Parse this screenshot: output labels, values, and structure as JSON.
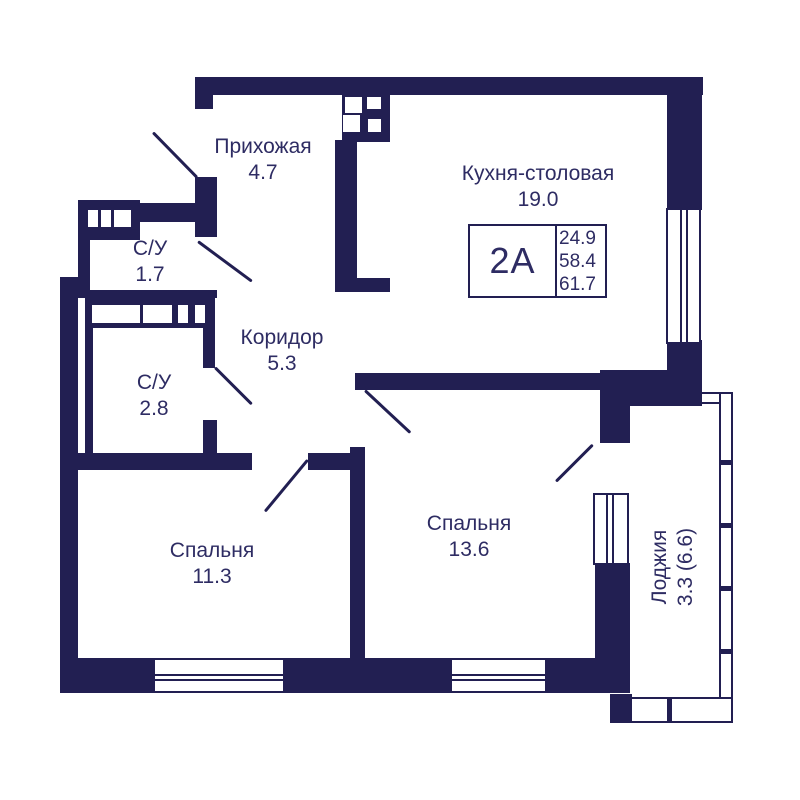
{
  "palette": {
    "wall_color": "#221f52",
    "text_color": "#2e2c63",
    "background_color": "#ffffff"
  },
  "rooms": {
    "hallway": {
      "name": "Прихожая",
      "area": "4.7"
    },
    "bath_small": {
      "name": "С/У",
      "area": "1.7"
    },
    "corridor": {
      "name": "Коридор",
      "area": "5.3"
    },
    "bath_large": {
      "name": "С/У",
      "area": "2.8"
    },
    "kitchen_dining": {
      "name": "Кухня-столовая",
      "area": "19.0"
    },
    "bedroom_left": {
      "name": "Спальня",
      "area": "11.3"
    },
    "bedroom_right": {
      "name": "Спальня",
      "area": "13.6"
    },
    "loggia": {
      "name": "Лоджия",
      "area": "3.3 (6.6)"
    }
  },
  "info_box": {
    "layout_code": "2А",
    "values": [
      "24.9",
      "58.4",
      "61.7"
    ]
  }
}
